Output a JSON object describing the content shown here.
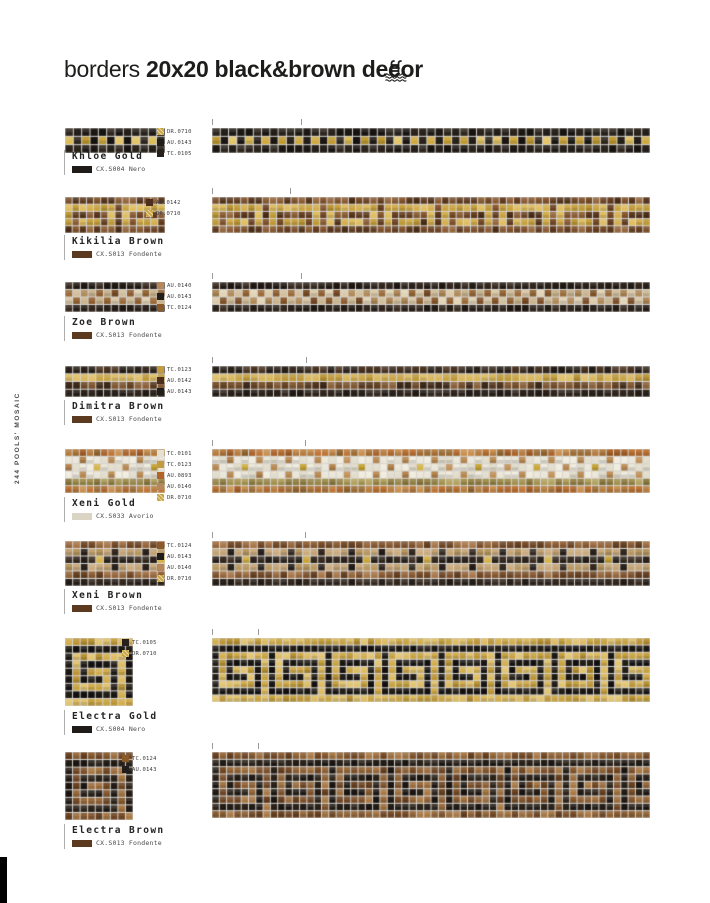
{
  "page": {
    "title_regular": "borders",
    "title_bold": "20x20 black&brown decor",
    "side_label": "244 POOLS' MOSAIC"
  },
  "render": {
    "grout": "#d8d5d0"
  },
  "patterns": {
    "key7": [
      [
        1,
        1,
        1,
        1,
        1,
        1,
        1,
        1
      ],
      [
        1,
        0,
        0,
        0,
        0,
        0,
        0,
        0
      ],
      [
        1,
        0,
        1,
        1,
        1,
        1,
        1,
        0
      ],
      [
        1,
        0,
        1,
        0,
        0,
        0,
        1,
        0
      ],
      [
        1,
        0,
        1,
        1,
        1,
        0,
        1,
        0
      ],
      [
        1,
        0,
        0,
        0,
        0,
        0,
        1,
        0
      ],
      [
        1,
        1,
        1,
        1,
        1,
        1,
        1,
        0
      ]
    ],
    "key3": [
      [
        1,
        1,
        1,
        1,
        1,
        1,
        1,
        0
      ],
      [
        1,
        0,
        0,
        0,
        0,
        0,
        1,
        0
      ],
      [
        1,
        0,
        1,
        1,
        1,
        0,
        1,
        0
      ]
    ]
  },
  "products": [
    {
      "name": "Khloe Gold",
      "code": "CX.S004 Nero",
      "chip": "#1f1b18",
      "pattern": "khloe",
      "rows": 3,
      "seed": 11,
      "colors": [
        {
          "code": "DR.0710",
          "hex": "#c9a43e",
          "hatch": true
        },
        {
          "code": "AU.0143",
          "hex": "#211d1a"
        },
        {
          "code": "TC.0105",
          "hex": "#26211d"
        }
      ],
      "palette": {
        "dark": [
          "#1e1915",
          "#27211b",
          "#2d261e",
          "#181411"
        ],
        "gold": [
          "#cfa93f",
          "#dcbc55",
          "#c09a30",
          "#e3c467"
        ]
      }
    },
    {
      "name": "Kikilia Brown",
      "code": "CX.S013 Fondente",
      "chip": "#5c3a20",
      "pattern": "kikilia",
      "rows": 5,
      "seed": 23,
      "colors": [
        {
          "code": "AU.0142",
          "hex": "#4c2f1c"
        },
        {
          "code": "DR.0710",
          "hex": "#c9a43e",
          "hatch": true
        }
      ],
      "palette": {
        "bg": [
          "#7a4e2a",
          "#6a4123",
          "#8a5a33",
          "#5e3a1f",
          "#93663c",
          "#4e3018"
        ],
        "gold": [
          "#d4ae4a",
          "#c8a23c",
          "#e0be5e",
          "#bd9833"
        ]
      }
    },
    {
      "name": "Zoe Brown",
      "code": "CX.S013 Fondente",
      "chip": "#5c3a20",
      "pattern": "zoe",
      "rows": 4,
      "seed": 37,
      "colors": [
        {
          "code": "AU.0140",
          "hex": "#b5875a"
        },
        {
          "code": "AU.0143",
          "hex": "#211d1a"
        },
        {
          "code": "TC.0124",
          "hex": "#8a5a28"
        }
      ],
      "palette": {
        "dark": [
          "#2c231c",
          "#241c16",
          "#36291f",
          "#1f1813"
        ],
        "light": [
          "#dbcaa9",
          "#d1bf9c",
          "#e2d4b6",
          "#c8b48e"
        ],
        "brown": [
          "#8c5c2e",
          "#7b4e26",
          "#9a6a38",
          "#b08a58"
        ]
      }
    },
    {
      "name": "Dimitra Brown",
      "code": "CX.S013 Fondente",
      "chip": "#5c3a20",
      "pattern": "rowbands",
      "rows": 4,
      "seed": 51,
      "colors": [
        {
          "code": "TC.0123",
          "hex": "#c39b3e"
        },
        {
          "code": "AU.0142",
          "hex": "#4c2f1c"
        },
        {
          "code": "AU.0143",
          "hex": "#211d1a"
        }
      ],
      "palette": {
        "bands": [
          [
            "#2b221b",
            "#231b15",
            "#3a2d22",
            "#4a3423"
          ],
          [
            "#c9a443",
            "#d8b65a",
            "#bd9837",
            "#e0c068"
          ],
          [
            "#6b4826",
            "#55371e",
            "#7d5530",
            "#8a6038",
            "#3f2a18"
          ],
          [
            "#2b221b",
            "#231b15",
            "#332821"
          ]
        ]
      }
    },
    {
      "name": "Xeni Gold",
      "code": "CX.S033 Avorio",
      "chip": "#d9d4c4",
      "pattern": "xeni_gold",
      "rows": 6,
      "seed": 67,
      "colors": [
        {
          "code": "TC.0101",
          "hex": "#e4e0d2"
        },
        {
          "code": "TC.0123",
          "hex": "#c39b3e"
        },
        {
          "code": "AU.0893",
          "hex": "#b26327"
        },
        {
          "code": "AU.0140",
          "hex": "#b5875a"
        },
        {
          "code": "DR.0710",
          "hex": "#c9a43e",
          "hatch": true
        }
      ],
      "palette": {
        "orange": [
          "#bf7433",
          "#a9632a",
          "#c98f4e",
          "#9a6a33",
          "#b57b3c"
        ],
        "ivory": [
          "#eae6d8",
          "#e2ddcc",
          "#f0ecdf"
        ],
        "tan": [
          "#c09058",
          "#b5854e"
        ],
        "gold": [
          "#c9a637",
          "#d6b44a"
        ],
        "olive": [
          "#a3914f",
          "#8f7d41",
          "#b3a25e",
          "#97854a"
        ]
      }
    },
    {
      "name": "Xeni Brown",
      "code": "CX.S013 Fondente",
      "chip": "#5c3a20",
      "pattern": "xeni_brown",
      "rows": 6,
      "seed": 83,
      "colors": [
        {
          "code": "TC.0124",
          "hex": "#8a5a28"
        },
        {
          "code": "AU.0143",
          "hex": "#211d1a"
        },
        {
          "code": "AU.0140",
          "hex": "#b5875a"
        },
        {
          "code": "DR.0710",
          "hex": "#c9a43e",
          "hatch": true
        }
      ],
      "palette": {
        "brown": [
          "#94643a",
          "#7b4f2b",
          "#a8764a",
          "#6b4424"
        ],
        "tan": [
          "#c2a273",
          "#b7965f",
          "#cbab7e"
        ],
        "dark": [
          "#2b221c",
          "#352a20",
          "#241c16"
        ],
        "dark2": [
          "#2e251d",
          "#3a2d22",
          "#271f18"
        ],
        "gold": [
          "#c9a637",
          "#d6b44a"
        ]
      }
    },
    {
      "name": "Electra Gold",
      "code": "CX.S004 Nero",
      "chip": "#1f1b18",
      "pattern": "electra",
      "rows": 9,
      "seed": 97,
      "colors": [
        {
          "code": "TC.0105",
          "hex": "#26211d"
        },
        {
          "code": "DR.0710",
          "hex": "#c9a43e",
          "hatch": true
        }
      ],
      "palette": {
        "bg": [
          "#d3ad4b",
          "#c7a23e",
          "#ddbb60",
          "#bb9434",
          "#e2c470"
        ],
        "fg": [
          "#1c1814",
          "#241f19",
          "#141110"
        ]
      }
    },
    {
      "name": "Electra Brown",
      "code": "CX.S013 Fondente",
      "chip": "#5c3a20",
      "pattern": "electra",
      "rows": 9,
      "seed": 113,
      "colors": [
        {
          "code": "TC.0124",
          "hex": "#8a5a28"
        },
        {
          "code": "AU.0143",
          "hex": "#211d1a"
        }
      ],
      "palette": {
        "bg": [
          "#8c5e32",
          "#7a4e28",
          "#9a6c3e",
          "#6b4322",
          "#a87844"
        ],
        "fg": [
          "#241d17",
          "#1c1612",
          "#2c241b"
        ]
      }
    }
  ]
}
